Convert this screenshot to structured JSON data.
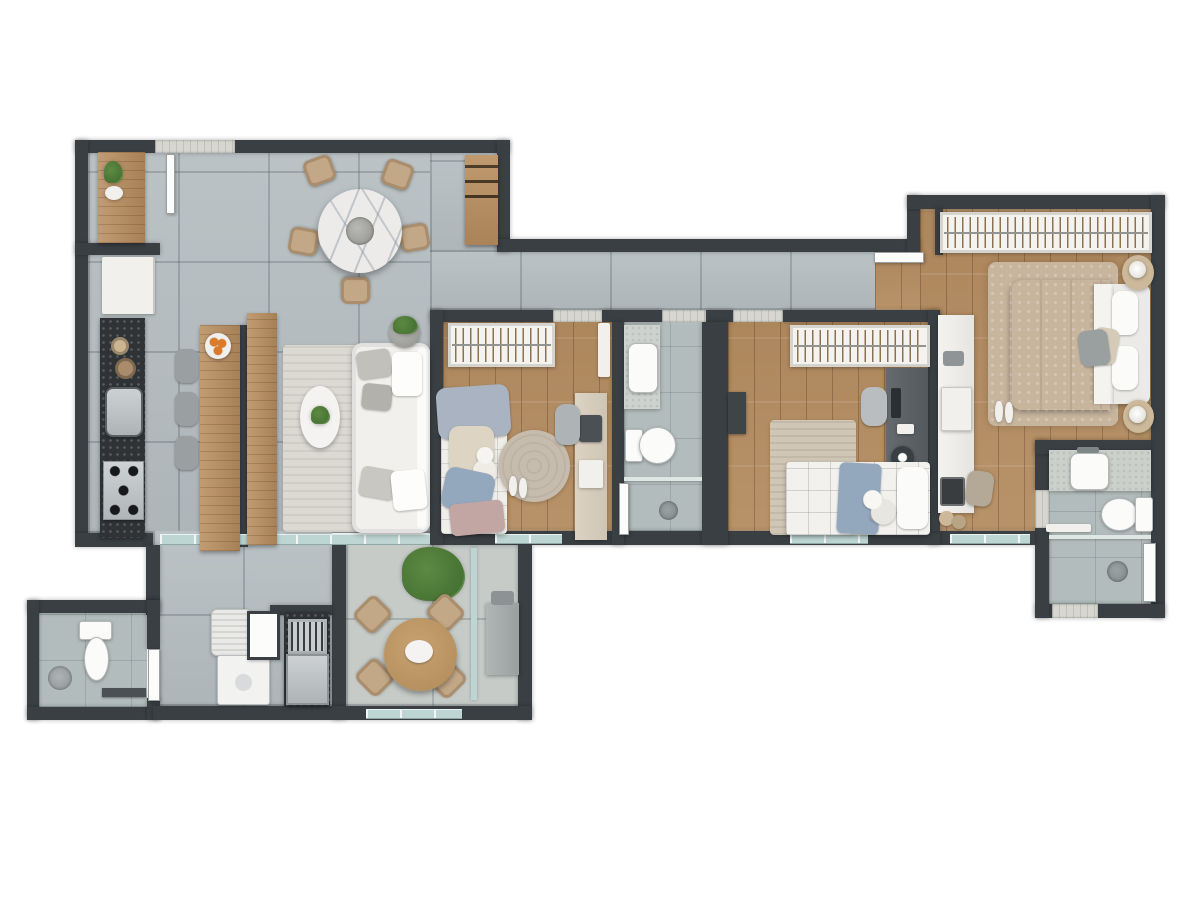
{
  "meta": {
    "title": "3D top-down apartment floor plan render",
    "render_style": "photorealistic dollhouse view",
    "background": "#ffffff"
  },
  "palette": {
    "wall": "#3a3f43",
    "tile": "#b7bfc2",
    "terrace": "#c6cbc8",
    "bath": "#b3bcbc",
    "wood": "#b48c60",
    "woodFurn": "#b98e5f",
    "granite": "#2f3336",
    "white": "#f1f0ed",
    "glass": "#bed6d3",
    "rugLiving": "#dbd9d2",
    "rugRound": "#c6bcae",
    "rugBd2": "#cfc6b5",
    "rugMaster": "#c8b59e",
    "chairBeige": "#c3a887",
    "cushionGray": "#c2c0bb",
    "duvetMaster": "#b2aba2",
    "duvetBlue": "#a9b3c1",
    "blanketBlue": "#93a7bd",
    "blanketPink": "#c2a6a4",
    "green": "#5d8a42",
    "greenDark": "#3f6b2e",
    "stainless": "#b9bdbf",
    "fruitOrange": "#d97b2a"
  },
  "counts": {
    "bedrooms": 3,
    "bathrooms": 3,
    "balconies": 1
  },
  "rooms": [
    {
      "id": "entry-pantry",
      "label": "service entry / pantry",
      "floor": "tile",
      "items": [
        "wood-counter",
        "potted-plant",
        "faucet"
      ]
    },
    {
      "id": "kitchen",
      "label": "kitchen",
      "floor": "tile",
      "items": [
        "refrigerator",
        "granite-countertop",
        "prep-bowls",
        "kitchen-sink",
        "gas-cooktop",
        "wood-island",
        "bar-stools x3",
        "fruit-plate"
      ]
    },
    {
      "id": "dining",
      "label": "dining area",
      "floor": "tile",
      "items": [
        "round-marble-table",
        "center-tray",
        "wicker-chairs x5",
        "wood-bar-shelf",
        "wine-bottles"
      ]
    },
    {
      "id": "living",
      "label": "living room",
      "floor": "tile",
      "items": [
        "white-sofa",
        "throw-cushions",
        "oval-coffee-table",
        "area-rug",
        "tv-sideboard",
        "potted-plant"
      ]
    },
    {
      "id": "hallway",
      "label": "hallway",
      "floor": "tile",
      "items": []
    },
    {
      "id": "bedroom-1",
      "label": "bedroom 1",
      "floor": "wood",
      "items": [
        "open-wardrobe",
        "single-bed",
        "teddy-bear",
        "round-rug",
        "slippers",
        "desk",
        "desk-chair",
        "laptop",
        "wall-shelf"
      ]
    },
    {
      "id": "bathroom",
      "label": "bathroom",
      "floor": "tile",
      "items": [
        "vanity-counter",
        "sink",
        "toilet",
        "shower-area",
        "floor-drain",
        "towel-panel"
      ]
    },
    {
      "id": "bedroom-2",
      "label": "bedroom 2",
      "floor": "wood",
      "items": [
        "open-wardrobe",
        "single-bed",
        "plush-toy",
        "area-rug",
        "desk",
        "monitor",
        "desk-chair",
        "waste-bin",
        "wall-shelf"
      ]
    },
    {
      "id": "master-bedroom",
      "label": "master suite",
      "floor": "wood",
      "items": [
        "open-wardrobe",
        "double-bed",
        "headboard",
        "nightstand x2",
        "table-lamp x2",
        "shag-rug",
        "slippers",
        "vanity-desk",
        "stool",
        "laptop",
        "entry-door"
      ]
    },
    {
      "id": "master-bathroom",
      "label": "master bathroom",
      "floor": "tile",
      "items": [
        "vanity-counter",
        "sink",
        "toilet",
        "shower-area",
        "glass-partition",
        "towel-bar",
        "floor-drain"
      ]
    },
    {
      "id": "guest-wc",
      "label": "guest wc / shower room",
      "floor": "tile",
      "items": [
        "toilet",
        "shower-head",
        "towel-bar",
        "door"
      ]
    },
    {
      "id": "service-area",
      "label": "laundry / gourmet area",
      "floor": "tile",
      "items": [
        "laundry-basket",
        "washing-machine",
        "bbq-grill-counter",
        "built-in-oven",
        "service-panel"
      ]
    },
    {
      "id": "balcony",
      "label": "balcony terrace",
      "floor": "concrete",
      "items": [
        "round-wood-table",
        "chairs x4",
        "potted-plant",
        "storage-cabinet",
        "glass-partition"
      ]
    }
  ]
}
